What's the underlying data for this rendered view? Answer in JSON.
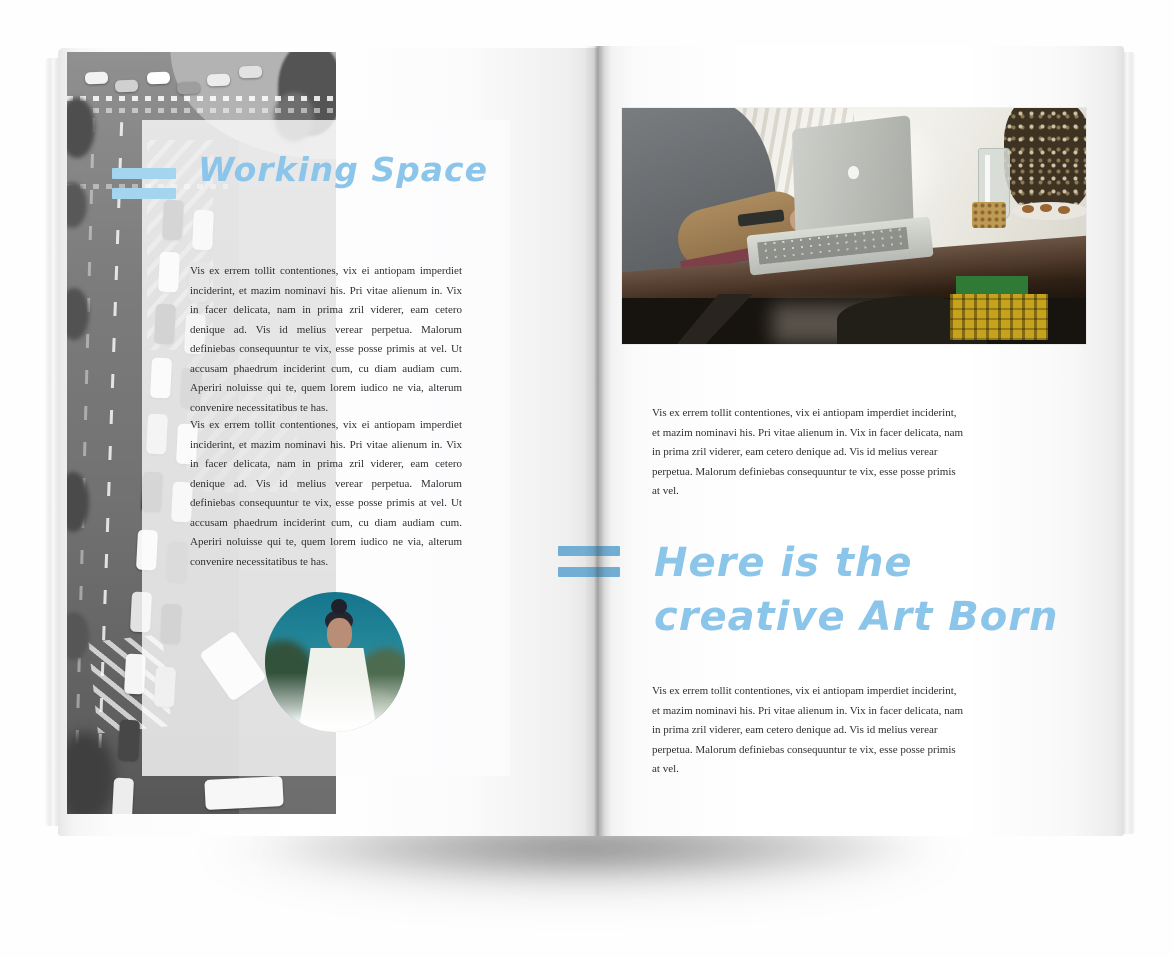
{
  "spread": {
    "left_page": {
      "heading": "Working Space",
      "paragraphs": [
        "Vis ex errem tollit contentiones, vix ei antiopam imperdiet inciderint, et mazim nominavi his. Pri vitae alienum in. Vix in facer delicata, nam in prima zril viderer, eam cetero denique ad. Vis id melius verear perpetua. Malorum definiebas consequuntur te vix, esse posse primis at vel. Ut accusam phaedrum inciderint cum, cu diam audiam cum. Aperiri noluisse qui te, quem lorem iudico ne via, alterum convenire necessitatibus te has.",
        "Vis ex errem tollit contentiones, vix ei antiopam imperdiet inciderint, et mazim nominavi his. Pri vitae alienum in. Vix in facer delicata, nam in prima zril viderer, eam cetero denique ad. Vis id melius verear perpetua. Malorum definiebas consequuntur te vix, esse posse primis at vel. Ut accusam phaedrum inciderint cum, cu diam audiam cum. Aperiri noluisse qui te, quem lorem iudico ne via, alterum convenire necessitatibus te has."
      ],
      "photos": {
        "street": "aerial-city-street-traffic-grayscale-photo",
        "portrait": "woman-with-hair-bun-circular-photo"
      }
    },
    "right_page": {
      "photo": "workspace-desk-macbook-photo",
      "paragraph_top": "Vis ex errem tollit contentiones, vix ei antiopam imperdiet inciderint, et mazim nominavi his. Pri vitae alienum in. Vix in facer delicata, nam in prima zril viderer, eam cetero denique ad. Vis id melius verear perpetua. Malorum definiebas consequuntur te vix, esse posse primis at vel.",
      "heading": {
        "line1": "Here is the",
        "line2": "creative Art Born"
      },
      "paragraph_bottom": "Vis ex errem tollit contentiones, vix ei antiopam imperdiet inciderint, et mazim nominavi his. Pri vitae alienum in. Vix in facer delicata, nam in prima zril viderer, eam cetero denique ad. Vis id melius verear perpetua. Malorum definiebas consequuntur te vix, esse posse primis at vel."
    },
    "accent_colors": {
      "heading_blue": "#8cc5ea",
      "equals_mark_left": "#a5d4ef",
      "equals_mark_right": "#72aed3"
    }
  }
}
